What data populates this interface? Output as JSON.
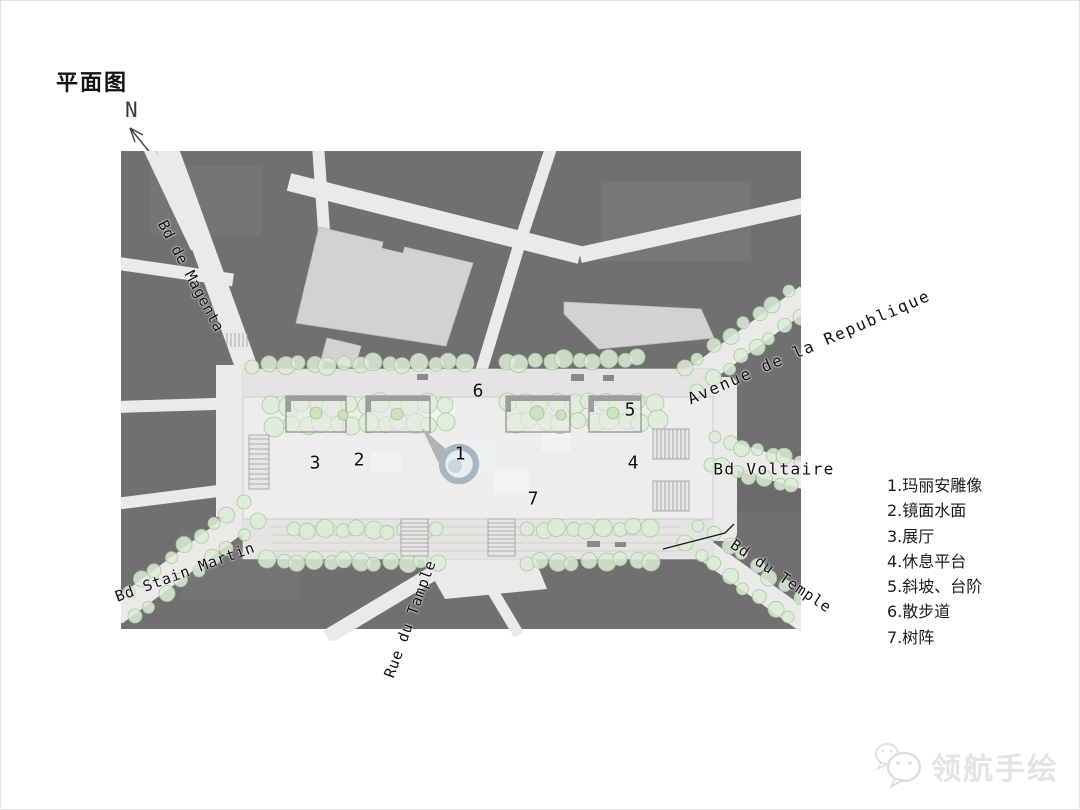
{
  "title": "平面图",
  "north_label": "N",
  "map": {
    "street_labels": {
      "bd_de_magenta": "Bd de Magenta",
      "avenue_de_la_republique": "Avenue de la Republique",
      "bd_voltaire": "Bd Voltaire",
      "bd_du_temple": "Bd du Temple",
      "bd_stain_martin": "Bd Stain Martin",
      "rue_du_tample": "Rue du Tample"
    },
    "markers": [
      "1",
      "2",
      "3",
      "4",
      "5",
      "6",
      "7"
    ]
  },
  "legend": {
    "items": [
      "1.玛丽安雕像",
      "2.镜面水面",
      "3.展厅",
      "4.休息平台",
      "5.斜坡、台阶",
      "6.散步道",
      "7.树阵"
    ]
  },
  "watermark": {
    "text": "领航手绘"
  },
  "colors": {
    "page_bg": "#ffffff",
    "block": "#707070",
    "block_light": "#d2d2d0",
    "street": "#eaeae8",
    "plaza": "#ededeb",
    "strip": "#e4e5e2",
    "tree_fill": "#ddecd7",
    "tree_stroke": "#a9c9a1",
    "statue_ring": "#a9b5c1",
    "statue_fill": "#e7edf2",
    "ink": "#141414",
    "watermark": "#e4e4e4"
  }
}
